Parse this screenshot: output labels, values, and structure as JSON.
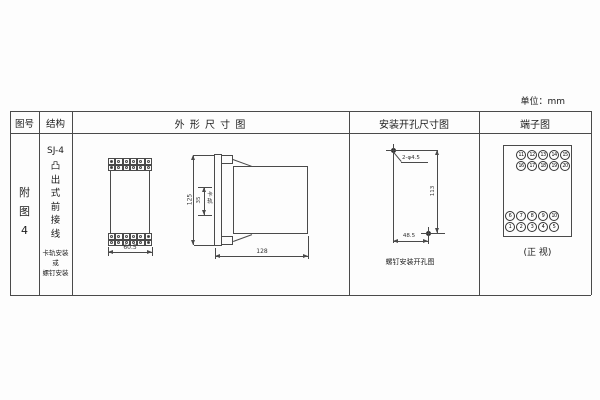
{
  "unit_label": "单位：mm",
  "table": {
    "headers": {
      "figure_no": "图号",
      "structure": "结构",
      "outline": "外 形 尺 寸 图",
      "mounting": "安装开孔尺寸图",
      "terminals": "端子图"
    }
  },
  "figure_number": {
    "chars": [
      "附",
      "图",
      "4"
    ]
  },
  "structure": {
    "model": "SJ-4",
    "type_chars": [
      "凸",
      "出",
      "式",
      "前",
      "接",
      "线"
    ],
    "mounting_lines": [
      "卡轨安装",
      "或",
      "螺钉安装"
    ]
  },
  "outline_dims": {
    "front_width": "60.5",
    "side_height": "125",
    "rail_slot": "35",
    "rail_slot_chars": [
      "卡",
      "轨"
    ],
    "depth": "128"
  },
  "mounting_diagram": {
    "holes_label": "2-φ4.5",
    "vertical_dim": "113",
    "horizontal_dim": "48.5",
    "caption": "螺钉安装开孔图"
  },
  "terminals": {
    "rows": [
      [
        "11",
        "12",
        "13",
        "14",
        "15"
      ],
      [
        "16",
        "17",
        "18",
        "19",
        "20"
      ],
      [
        "6",
        "7",
        "8",
        "9",
        "10"
      ],
      [
        "1",
        "2",
        "3",
        "4",
        "5"
      ]
    ],
    "caption": "(正 视)"
  }
}
